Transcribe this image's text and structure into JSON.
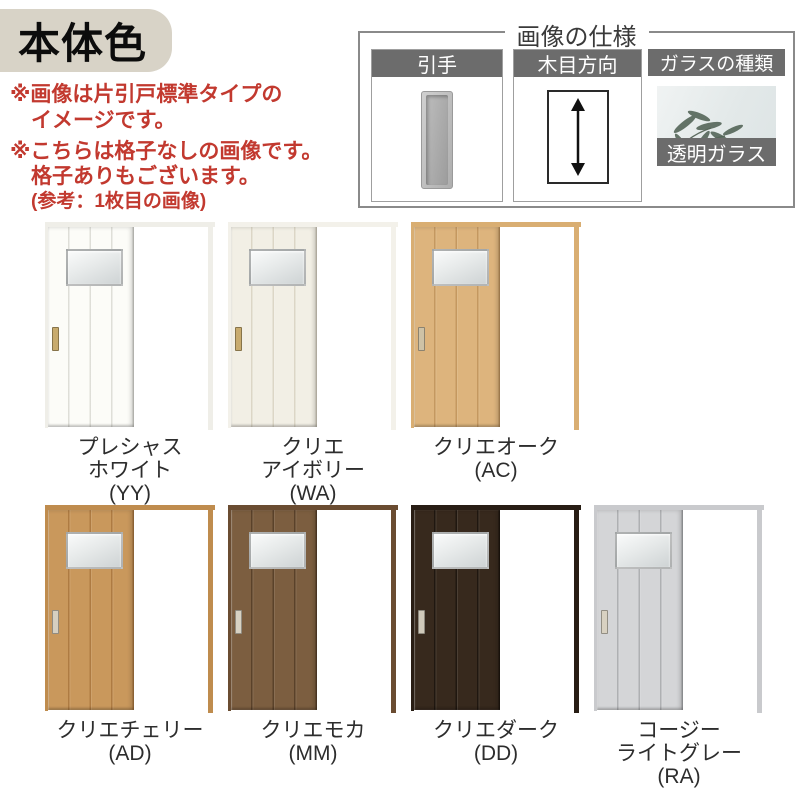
{
  "title": {
    "text": "本体色",
    "bg": "#d8d3c7",
    "text_color": "#0c0c0c"
  },
  "notes": {
    "color": "#c2392f",
    "note1_lines": [
      "※画像は片引戸標準タイプの",
      "イメージです。"
    ],
    "note2_lines": [
      "※こちらは格子なしの画像です。",
      "格子ありもございます。",
      "(参考：1枚目の画像)"
    ]
  },
  "spec_box": {
    "title": "画像の仕様",
    "border_color": "#8a8a8a",
    "header_bg": "#6c6c6c",
    "header_text_color": "#ffffff",
    "panels": {
      "handle": {
        "label": "引手"
      },
      "grain": {
        "label": "木目方向"
      },
      "glass": {
        "label": "ガラスの種類",
        "footer": "透明ガラス"
      }
    }
  },
  "doors": {
    "label_color": "#2d2d2d",
    "rows": [
      [
        {
          "lines": [
            "プレシャス",
            "ホワイト",
            "(YY)"
          ],
          "face": "#fcfcf8",
          "frame": "#efeee8",
          "plank": "rgba(187,187,178,0.45)",
          "handle": "#c8ab6e"
        },
        {
          "lines": [
            "クリエ",
            "アイボリー",
            "(WA)"
          ],
          "face": "#f2efe5",
          "frame": "#f3f1ea",
          "plank": "rgba(205,198,178,0.60)",
          "handle": "#c8ab6e"
        },
        {
          "lines": [
            "クリエオーク",
            "(AC)"
          ],
          "face": "#ddb47d",
          "frame": "#d9ae72",
          "plank": "rgba(166,118,61,0.45)",
          "handle": "#cec2a6"
        }
      ],
      [
        {
          "lines": [
            "クリエチェリー",
            "(AD)"
          ],
          "face": "#c9985c",
          "frame": "#bf8c4e",
          "plank": "rgba(148,94,40,0.50)",
          "handle": "#d6cfc0"
        },
        {
          "lines": [
            "クリエモカ",
            "(MM)"
          ],
          "face": "#7c5e40",
          "frame": "#6a4c31",
          "plank": "rgba(62,42,24,0.55)",
          "handle": "#d8d2c3"
        },
        {
          "lines": [
            "クリエダーク",
            "(DD)"
          ],
          "face": "#37291d",
          "frame": "#281d14",
          "plank": "rgba(12,8,5,0.55)",
          "handle": "#cfc9ba"
        },
        {
          "lines": [
            "コージー",
            "ライトグレー",
            "(RA)"
          ],
          "face": "#d4d5d7",
          "frame": "#c9cacd",
          "plank": "rgba(128,130,134,0.45)",
          "handle": "#d8d1c1"
        }
      ]
    ]
  }
}
